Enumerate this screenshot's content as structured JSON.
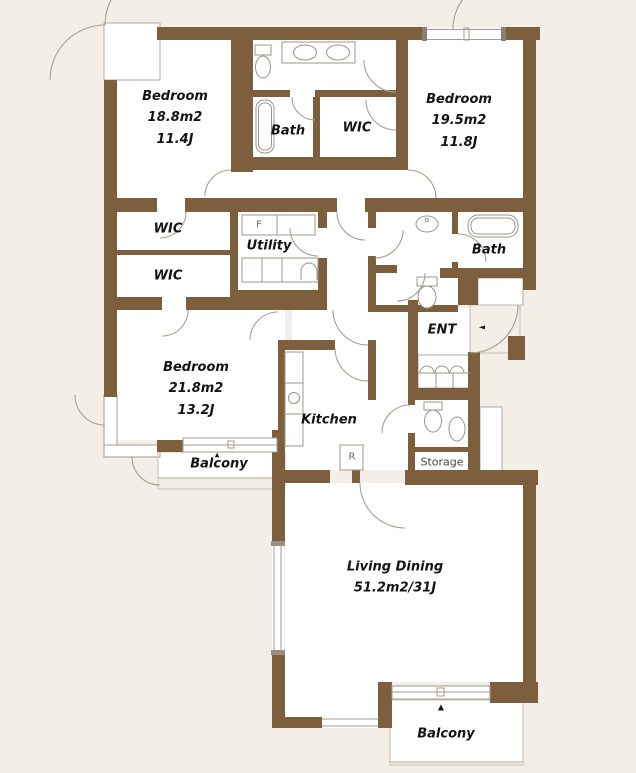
{
  "plan_title": "Apartment floor plan",
  "colors": {
    "background": "#f3efe8",
    "wall": "#7d5f3e",
    "room": "#ffffff",
    "outline_gray": "#b2a99c",
    "door_arc": "#a89f90",
    "fixture": "#9c948a",
    "text": "#141414"
  },
  "rooms": {
    "bedroom1": {
      "label": "Bedroom\n18.8m2\n11.4J"
    },
    "bath1": {
      "label": "Bath"
    },
    "wic_top": {
      "label": "WIC"
    },
    "bedroom2": {
      "label": "Bedroom\n19.5m2\n11.8J"
    },
    "wic1": {
      "label": "WIC"
    },
    "wic2": {
      "label": "WIC"
    },
    "utility": {
      "label": "Utility"
    },
    "bath2": {
      "label": "Bath"
    },
    "ent": {
      "label": "ENT"
    },
    "bedroom3": {
      "label": "Bedroom\n21.8m2\n13.2J"
    },
    "kitchen": {
      "label": "Kitchen"
    },
    "balcony1": {
      "label": "Balcony"
    },
    "storage": {
      "label": "Storage"
    },
    "living": {
      "label": "Living Dining\n51.2m2/31J"
    },
    "balcony2": {
      "label": "Balcony"
    }
  },
  "appliances": {
    "laundry": "F",
    "fridge": "R"
  },
  "markers": {
    "entry_arrow": "◄",
    "balcony1_arrow": "▲",
    "balcony2_arrow": "▲"
  }
}
